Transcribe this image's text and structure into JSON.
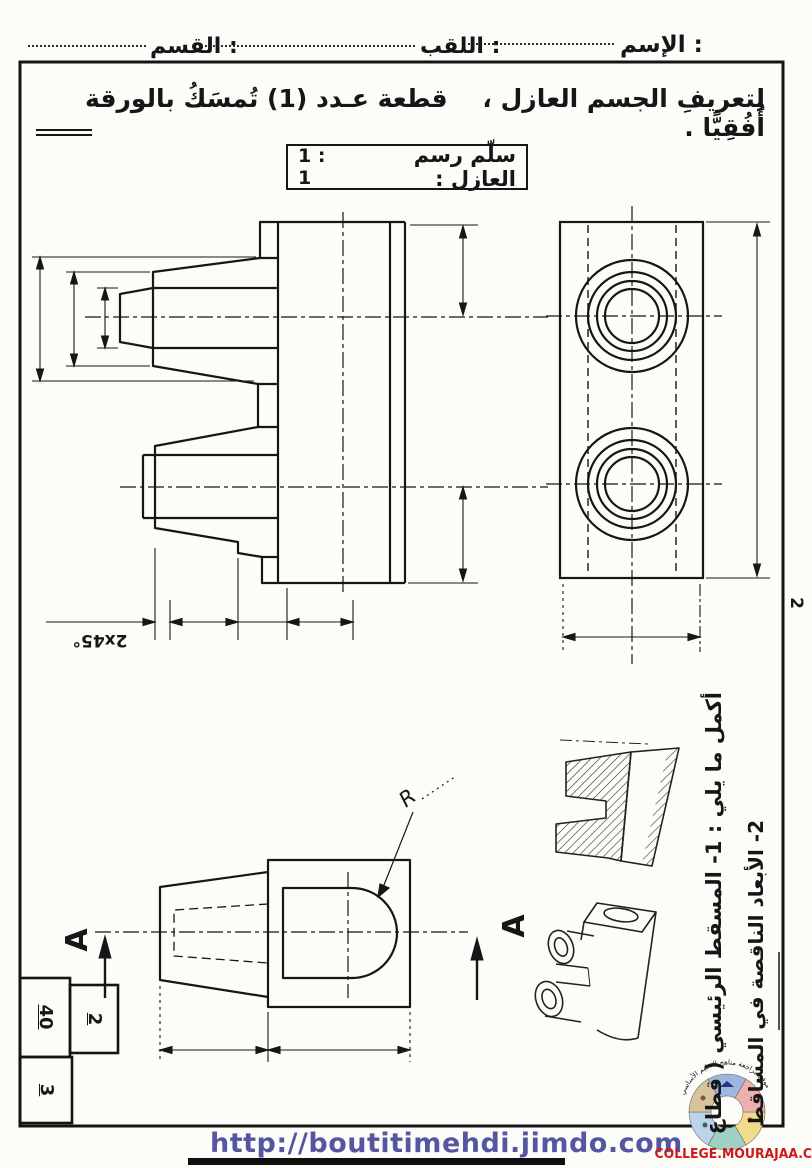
{
  "page": {
    "number": "2"
  },
  "header": {
    "name_label": "الإسم :",
    "surname_label": "اللقب :",
    "class_label": "القسم :"
  },
  "instruction": "لِتعريفِ الجسم العازل ،    قطعة عـدد (1) تُمسَكُ بالورقة أُفُقِيًّا .",
  "scale_box": {
    "label": "سلّم رسم العازل :",
    "value": "1 : 1"
  },
  "drawing_labels": {
    "chamfer": "2x45°",
    "radius": "R",
    "section_letter": "A"
  },
  "score_boxes": [
    {
      "value": "40"
    },
    {
      "value": "2"
    },
    {
      "value": "3"
    }
  ],
  "side_notes": {
    "line1": "أكمل ما يلي :  1- المسقط الرئيسي ( قطاع",
    "line2": "2- الأبعاد الناقصة في المساقط"
  },
  "footer": {
    "url": "http://boutitimehdi.jimdo.com",
    "site": "COLLEGE.MOURAJAA.COM",
    "logo_text": "موقع مراجعة مناهج التعليم الأساسي"
  }
}
